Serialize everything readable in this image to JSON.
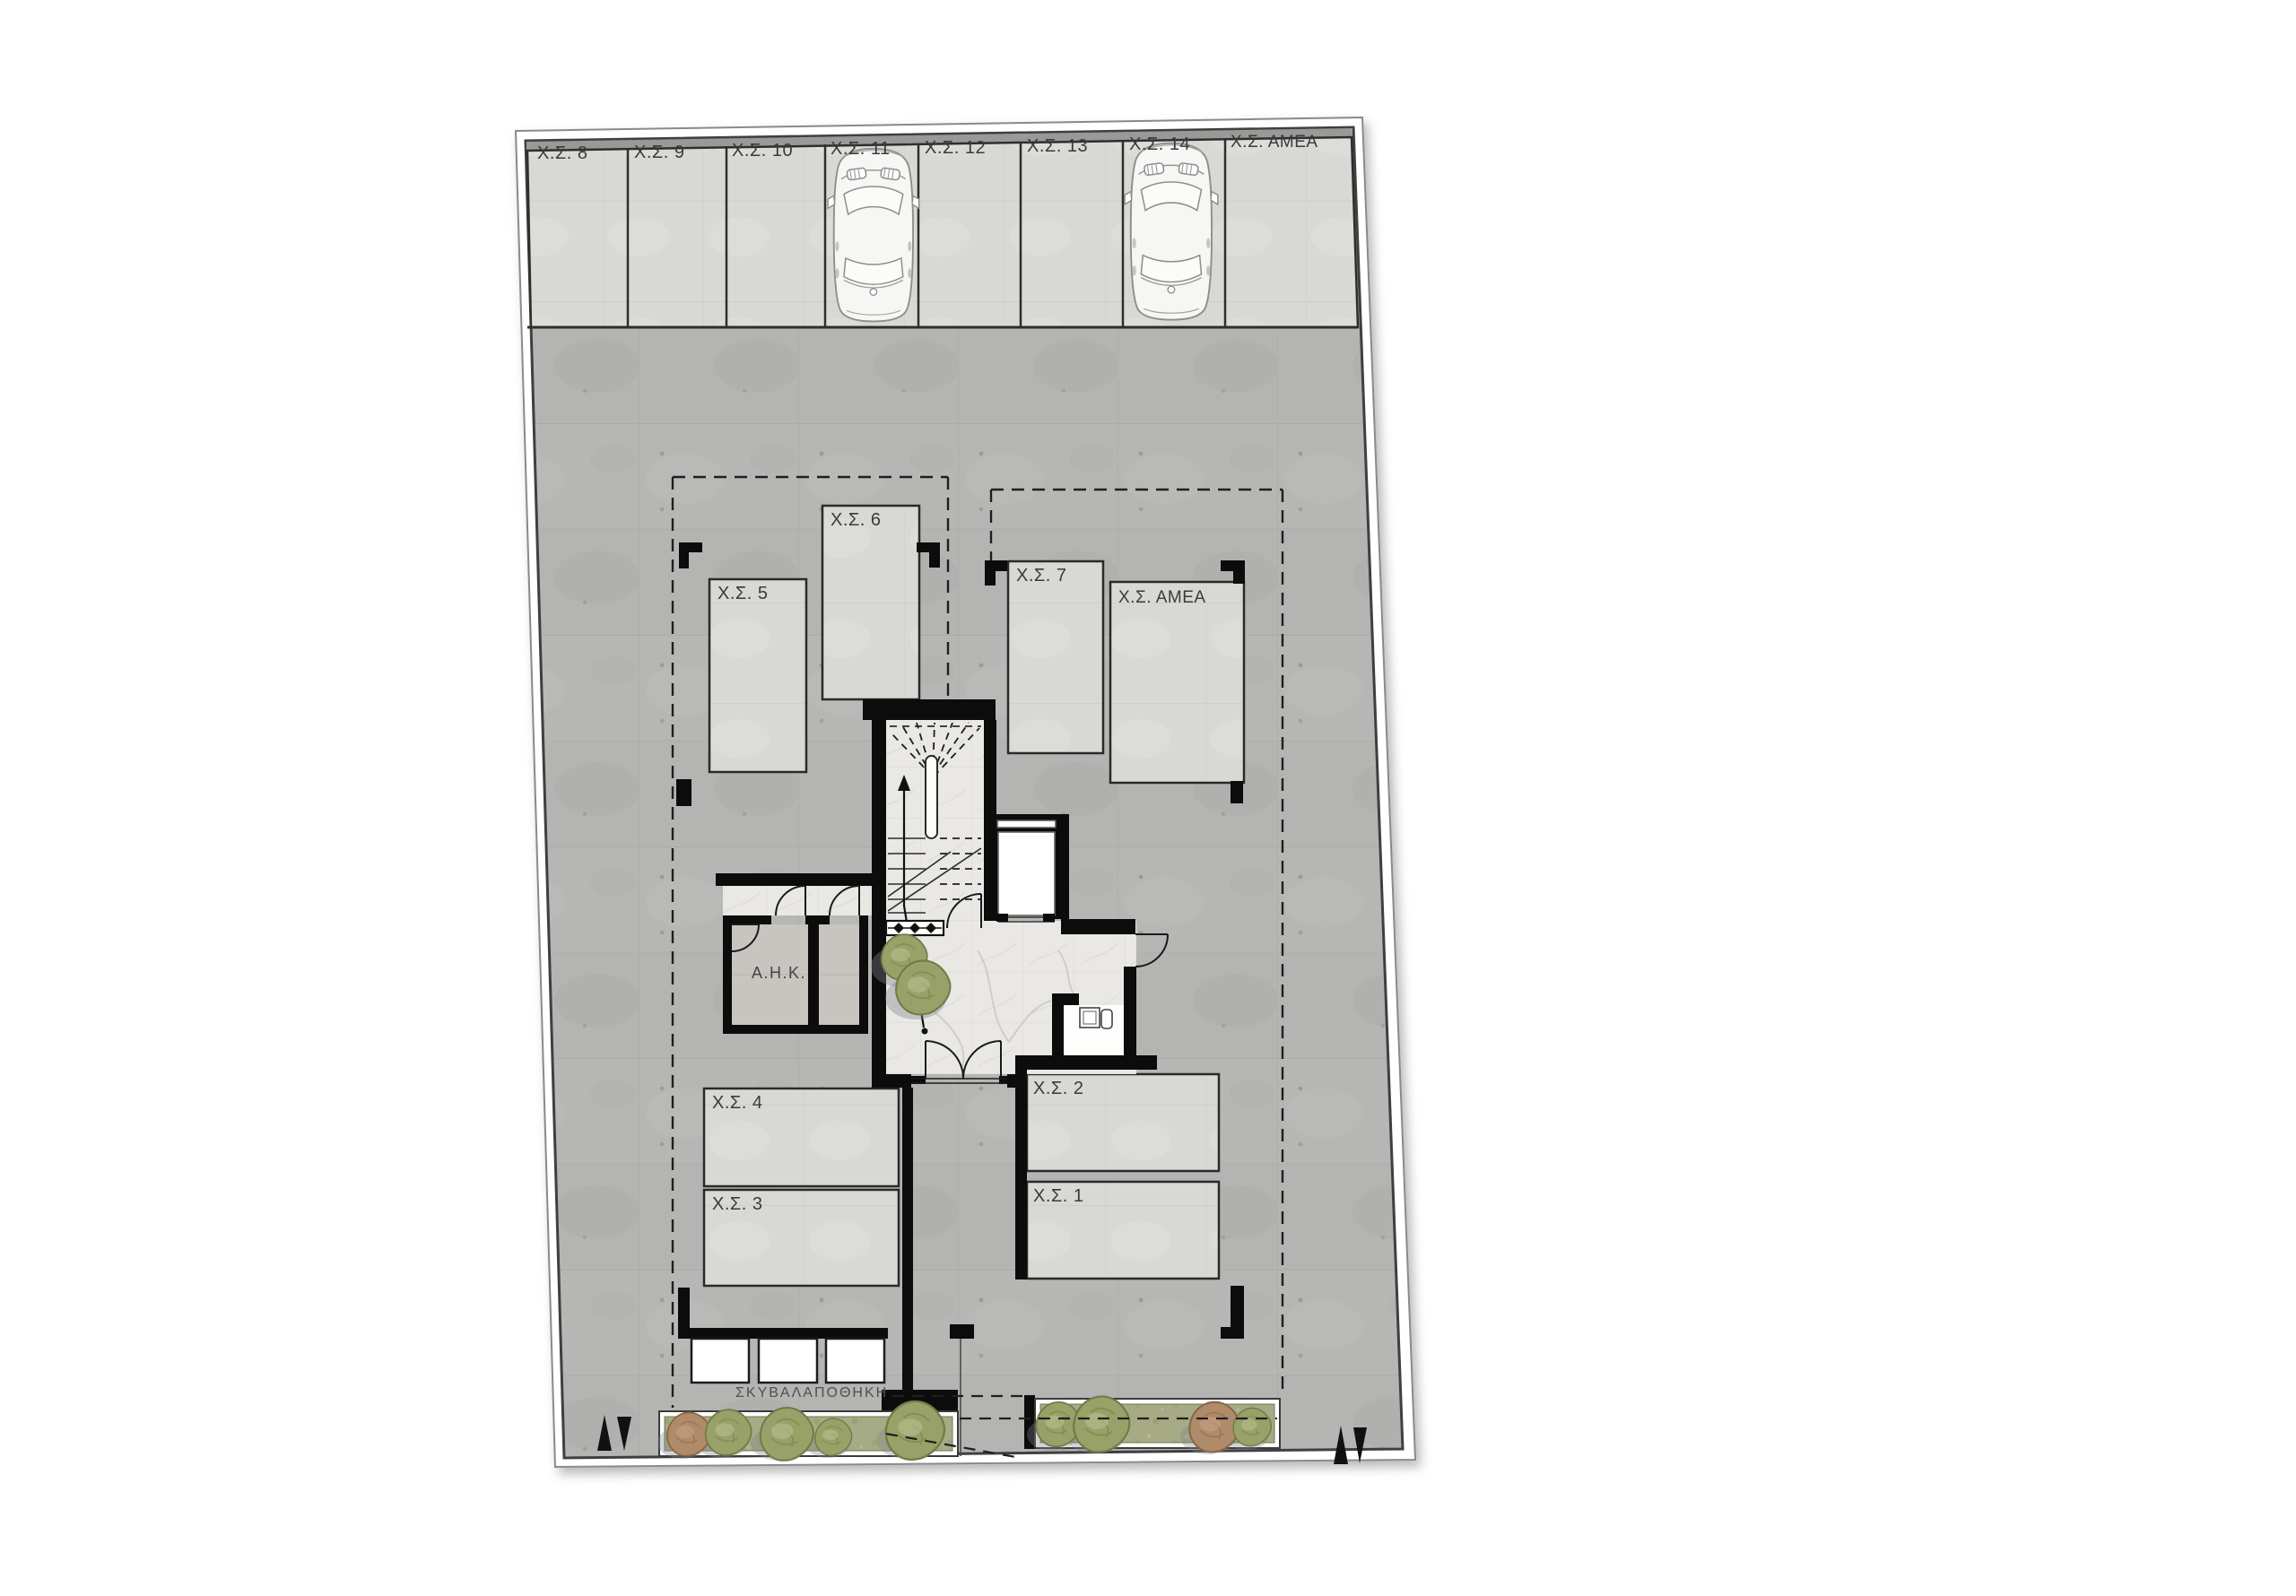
{
  "floor_plan": {
    "drawing_type": "ground-floor parking plan",
    "parking": {
      "top_row": [
        "Χ.Σ. 8",
        "Χ.Σ. 9",
        "Χ.Σ. 10",
        "Χ.Σ. 11",
        "Χ.Σ. 12",
        "Χ.Σ. 13",
        "Χ.Σ. 14",
        "Χ.Σ. ΑΜΕΑ"
      ],
      "middle": [
        "Χ.Σ. 5",
        "Χ.Σ. 6",
        "Χ.Σ. 7",
        "Χ.Σ. ΑΜΕΑ"
      ],
      "lower": [
        "Χ.Σ. 4",
        "Χ.Σ. 3",
        "Χ.Σ. 2",
        "Χ.Σ. 1"
      ],
      "cars_parked_in": [
        "Χ.Σ. 11",
        "Χ.Σ. 14"
      ]
    },
    "rooms": {
      "electrical": "Α.Η.Κ.",
      "garbage_store": "ΣΚΥΒΑΛΑΠΟΘΗΚΗ"
    },
    "colors": {
      "concrete": "#b4b5b2",
      "stall_fill": "#d8d8d5",
      "lobby_floor": "#e9e8e4",
      "wall": "#0c0c0c",
      "planter_green": "#a7ab85",
      "bush_green": "#99a169",
      "bush_brown": "#b08b69",
      "line": "#2f2f2f"
    }
  }
}
